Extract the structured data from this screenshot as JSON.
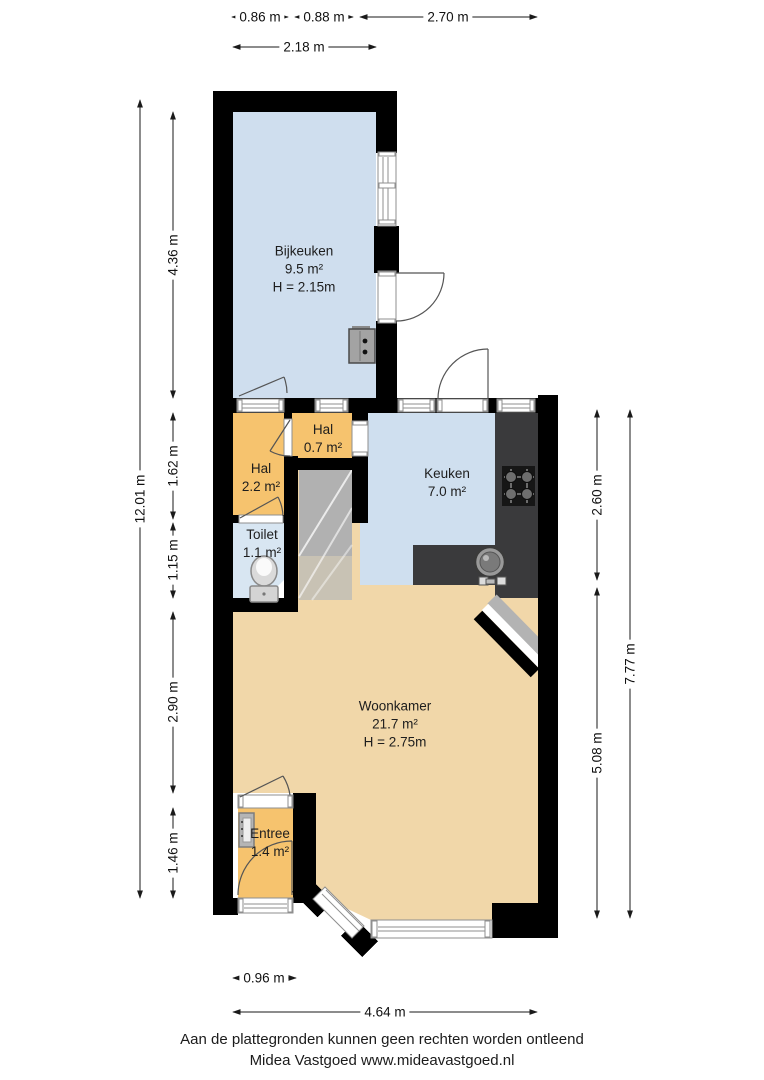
{
  "page": {
    "background": "#ffffff"
  },
  "rooms": {
    "bijkeuken": {
      "name": "Bijkeuken",
      "area": "9.5 m²",
      "ceiling_height": "H = 2.15m",
      "color": "#cfdeee"
    },
    "hal_boven": {
      "name": "Hal",
      "area": "0.7 m²",
      "color": "#f6c36e"
    },
    "hal": {
      "name": "Hal",
      "area": "2.2 m²",
      "color": "#f6c36e"
    },
    "keuken": {
      "name": "Keuken",
      "area": "7.0 m²",
      "color": "#cfdfef"
    },
    "toilet": {
      "name": "Toilet",
      "area": "1.1 m²",
      "color": "#d8e6f2"
    },
    "woonkamer": {
      "name": "Woonkamer",
      "area": "21.7 m²",
      "ceiling_height": "H = 2.75m",
      "color": "#f1d7a9"
    },
    "entree": {
      "name": "Entree",
      "area": "1.4 m²",
      "color": "#f6c36e"
    }
  },
  "dimensions": {
    "top_row1": [
      "0.86 m",
      "0.88 m",
      "2.70 m"
    ],
    "top_row2": "2.18 m",
    "left_outer": "12.01 m",
    "left_inner": [
      "4.36 m",
      "1.62 m",
      "1.15 m",
      "2.90 m",
      "1.46 m"
    ],
    "right_inner": [
      "2.60 m",
      "5.08 m"
    ],
    "right_outer": "7.77 m",
    "bottom": [
      "0.96 m",
      "4.64 m"
    ]
  },
  "footer": {
    "line1": "Aan de plattegronden kunnen geen rechten worden ontleend",
    "line2": "Midea Vastgoed www.mideavastgoed.nl"
  },
  "palette": {
    "wall": "#000000",
    "counter": "#3a3a3c",
    "stairs": "#b1b1b1",
    "dimension_line": "#1a1a1a",
    "text": "#1d1d1d"
  }
}
